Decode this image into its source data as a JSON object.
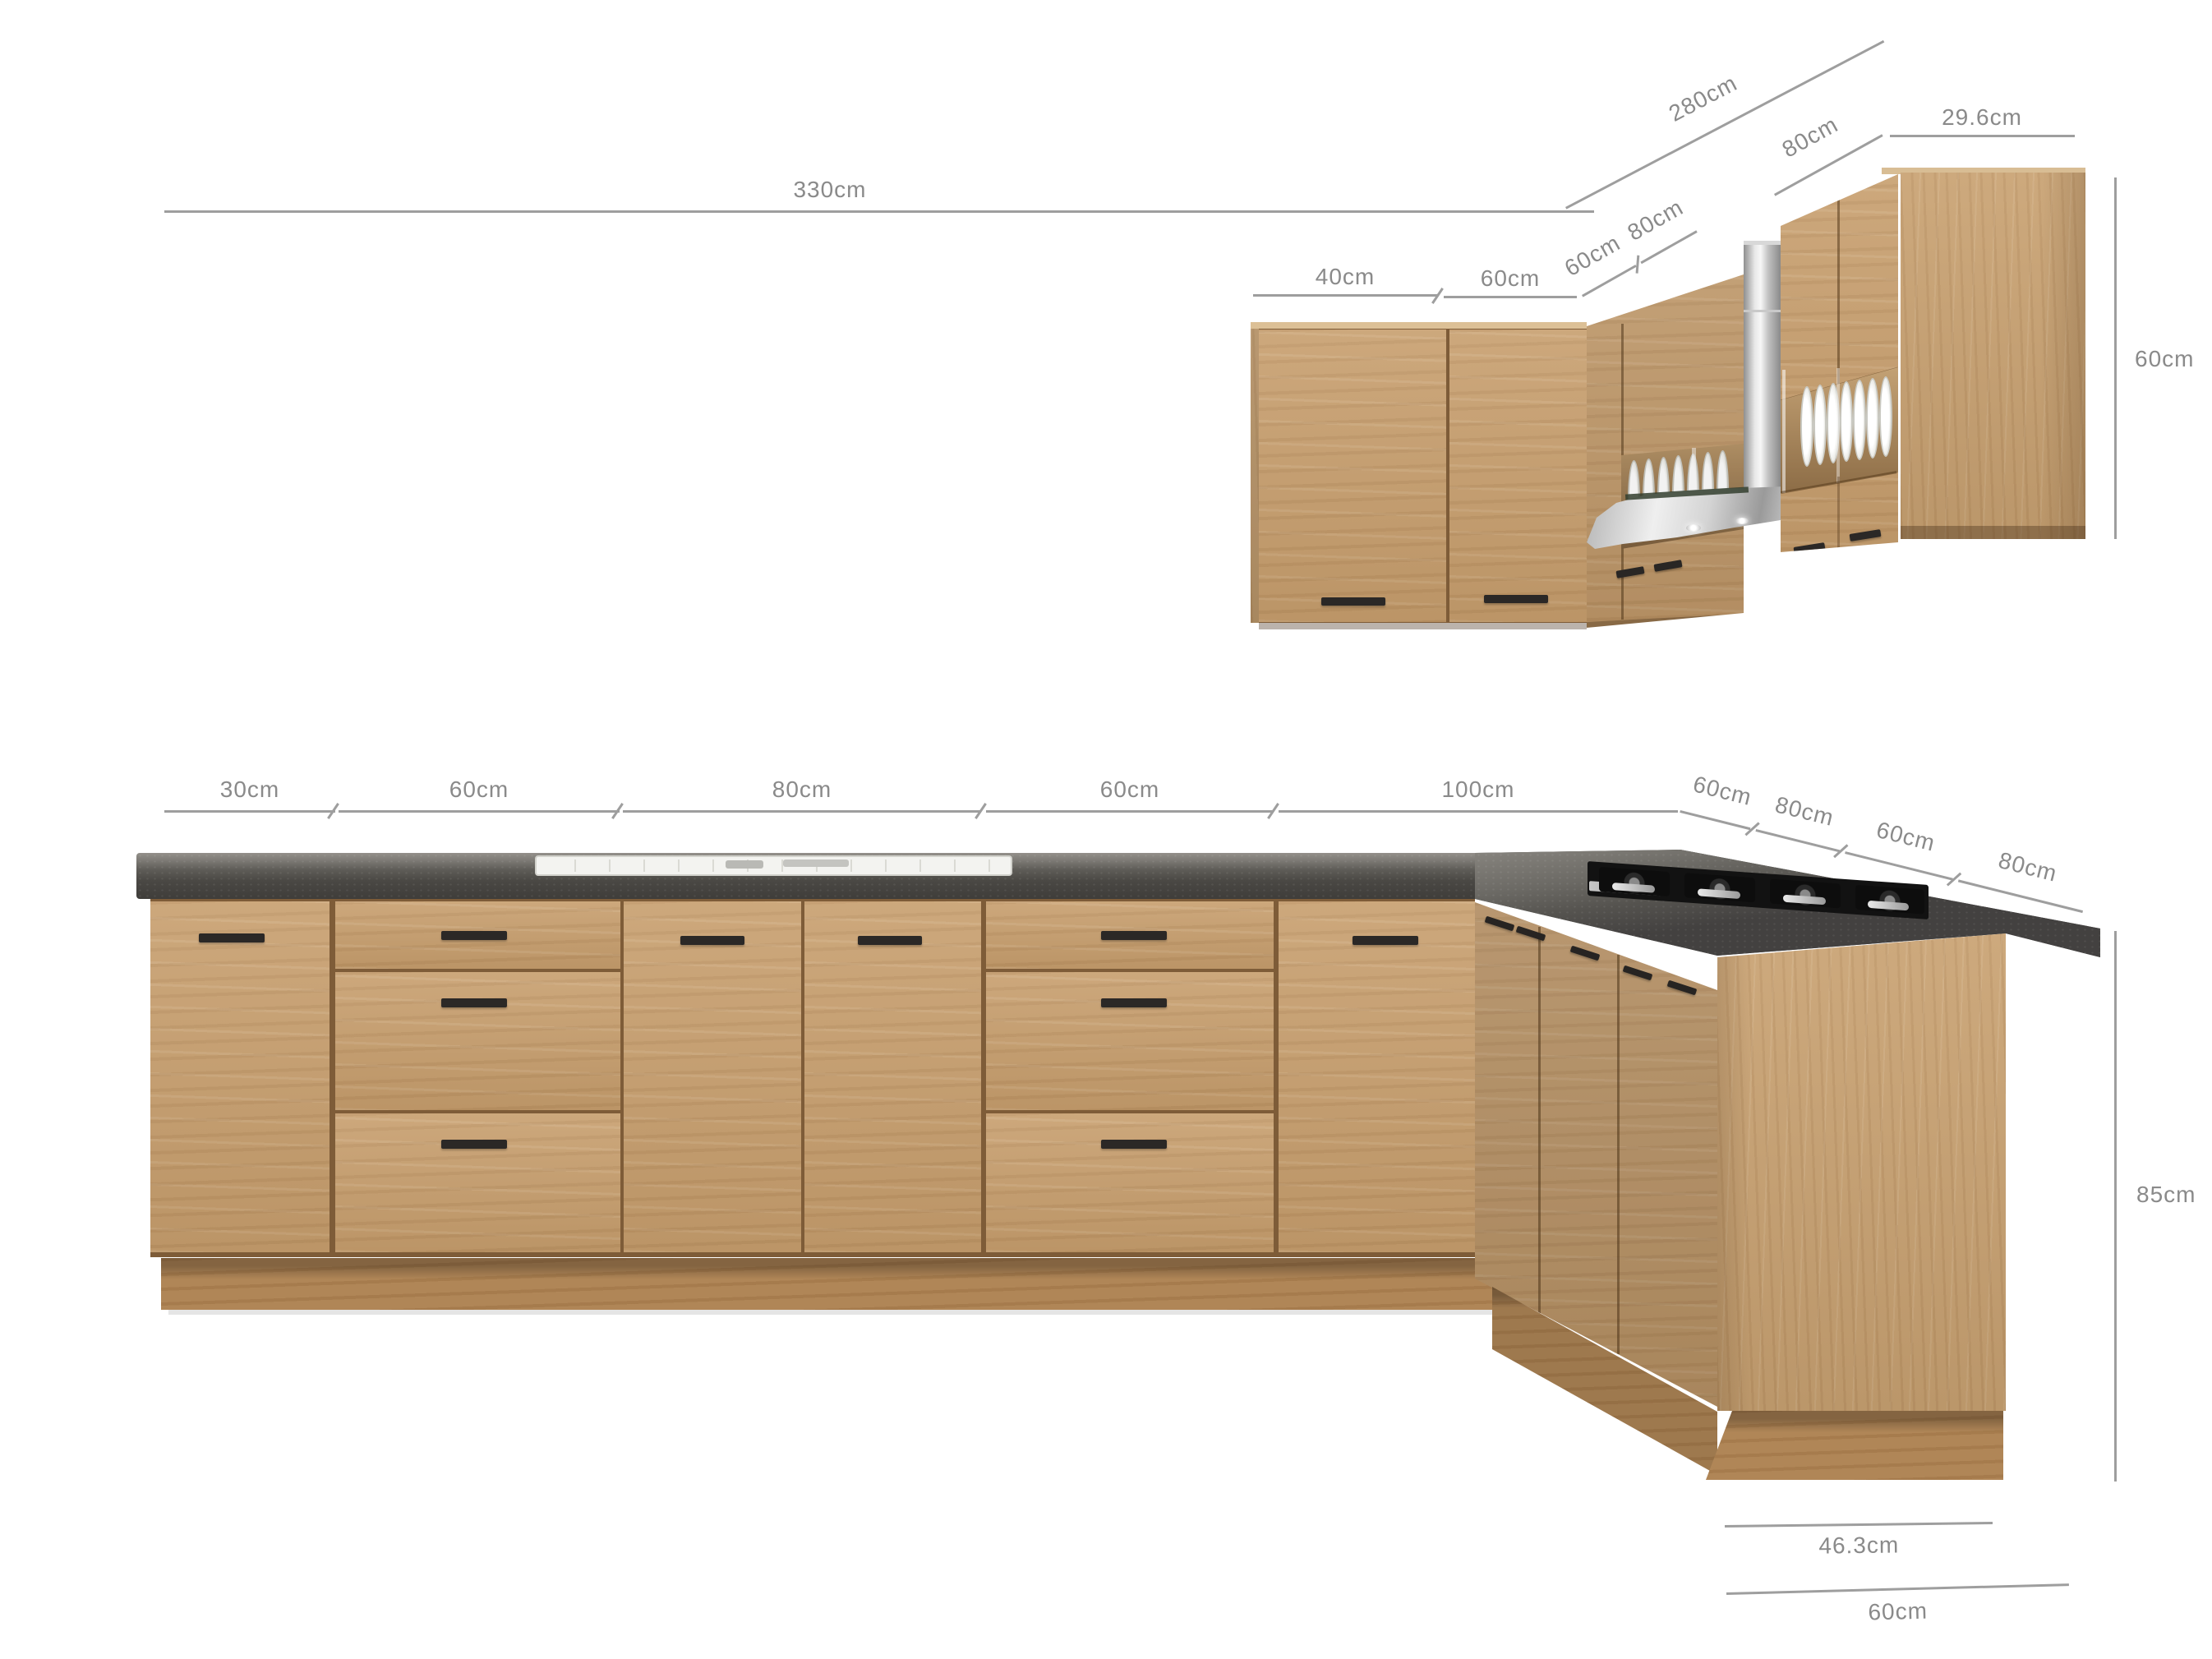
{
  "diagram": {
    "background_color": "#ffffff",
    "dimension_line_color": "#9e9e9e",
    "dimension_label_color": "#8a8a8a",
    "wood_color": "#c79e6d",
    "countertop_color": "#4a4845",
    "handle_color": "#2b2826",
    "steel_color": "#d9d9d9"
  },
  "wall_section": {
    "total_width": "330cm",
    "return_width": "280cm",
    "return_segment": "80cm",
    "end_depth": "29.6cm",
    "door_widths": [
      "40cm",
      "60cm"
    ],
    "corner_widths": [
      "60cm",
      "80cm"
    ],
    "cabinet_height": "60cm"
  },
  "base_section": {
    "segment_widths": [
      "30cm",
      "60cm",
      "80cm",
      "60cm",
      "100cm"
    ],
    "return_segment_widths": [
      "60cm",
      "80cm",
      "60cm",
      "80cm"
    ],
    "cabinet_height": "85cm",
    "end_depths": [
      "46.3cm",
      "60cm"
    ]
  }
}
